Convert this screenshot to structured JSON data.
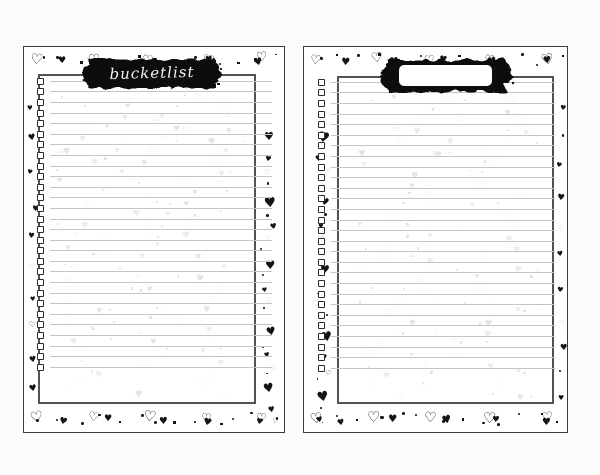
{
  "document": {
    "description": "Bucket list planner pages, two-page spread with heart borders",
    "pages": [
      {
        "name": "left",
        "title": "bucketlist",
        "banner_type": "black-brush-with-script-title",
        "rows": 28
      },
      {
        "name": "right",
        "title": "",
        "banner_type": "black-brush-with-blank-label",
        "rows": 28
      }
    ]
  },
  "colors": {
    "canvas_bg": "#fbfbfb",
    "page_bg": "#ffffff",
    "page_border": "#3c3c3c",
    "panel_border": "#525252",
    "ink": "#141414",
    "ink_light": "#bdbdbd",
    "banner_fill": "#0c0c0c",
    "banner_text": "#f4f4f4",
    "writing_line": "#c5c5c5",
    "faint_heart": "#e4e4e4",
    "faint_heart_alt": "#ececec",
    "faint_dot": "#e0e0e0",
    "blank_label_bg": "#ffffff"
  },
  "icons": {
    "heart_filled": "♥",
    "heart_outline": "♡"
  }
}
